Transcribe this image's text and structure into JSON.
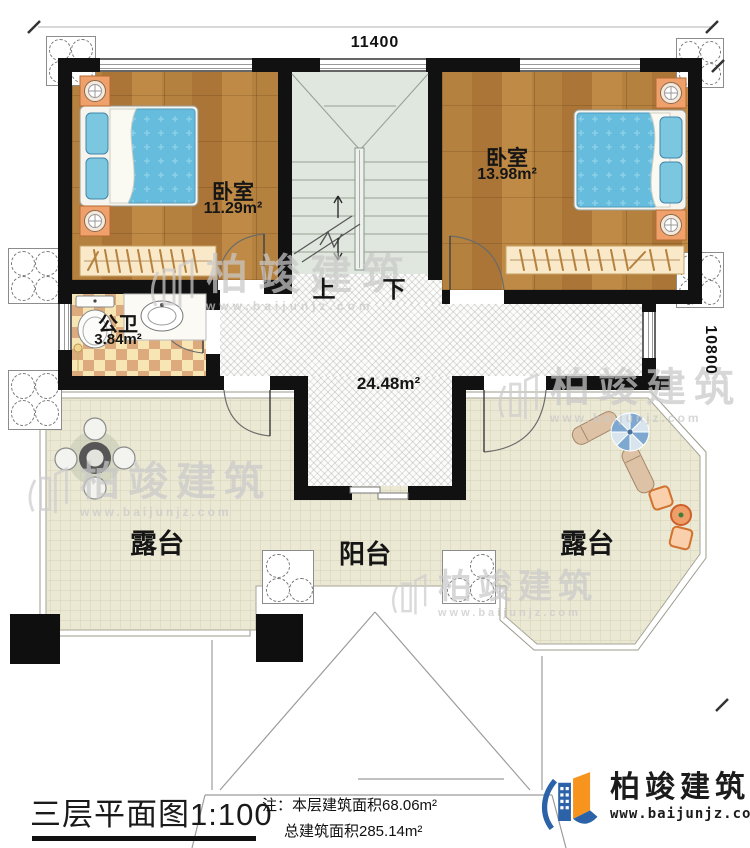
{
  "dimensions": {
    "top": "11400",
    "right": "10800"
  },
  "stairs": {
    "up": "上",
    "down": "下"
  },
  "rooms": {
    "bedroom_left": {
      "name": "卧室",
      "area": "11.29m²"
    },
    "bedroom_right": {
      "name": "卧室",
      "area": "13.98m²"
    },
    "bathroom": {
      "name": "公卫",
      "area": "3.84m²"
    },
    "hall_area": "24.48m²",
    "terrace_left": "露台",
    "terrace_right": "露台",
    "balcony": "阳台"
  },
  "title_block": {
    "title": "三层平面图1:100",
    "note_label": "注：",
    "note_line1": "本层建筑面积68.06m²",
    "note_line2": "总建筑面积285.14m²"
  },
  "brand": {
    "name": "柏竣建筑",
    "url": "www.baijunjz.com"
  },
  "watermark": {
    "name": "柏竣建筑",
    "url": "www.baijunjz.com"
  },
  "colors": {
    "wall": "#111111",
    "wood_floor": "#b27d3c",
    "stair_floor": "#e0e7de",
    "terrace_floor": "#ebe8d4",
    "bed_quilt": "#66bcdc",
    "tile_check": "#dcaa7c",
    "brand_blue": "#2b62a8",
    "brand_orange": "#f7941d"
  }
}
